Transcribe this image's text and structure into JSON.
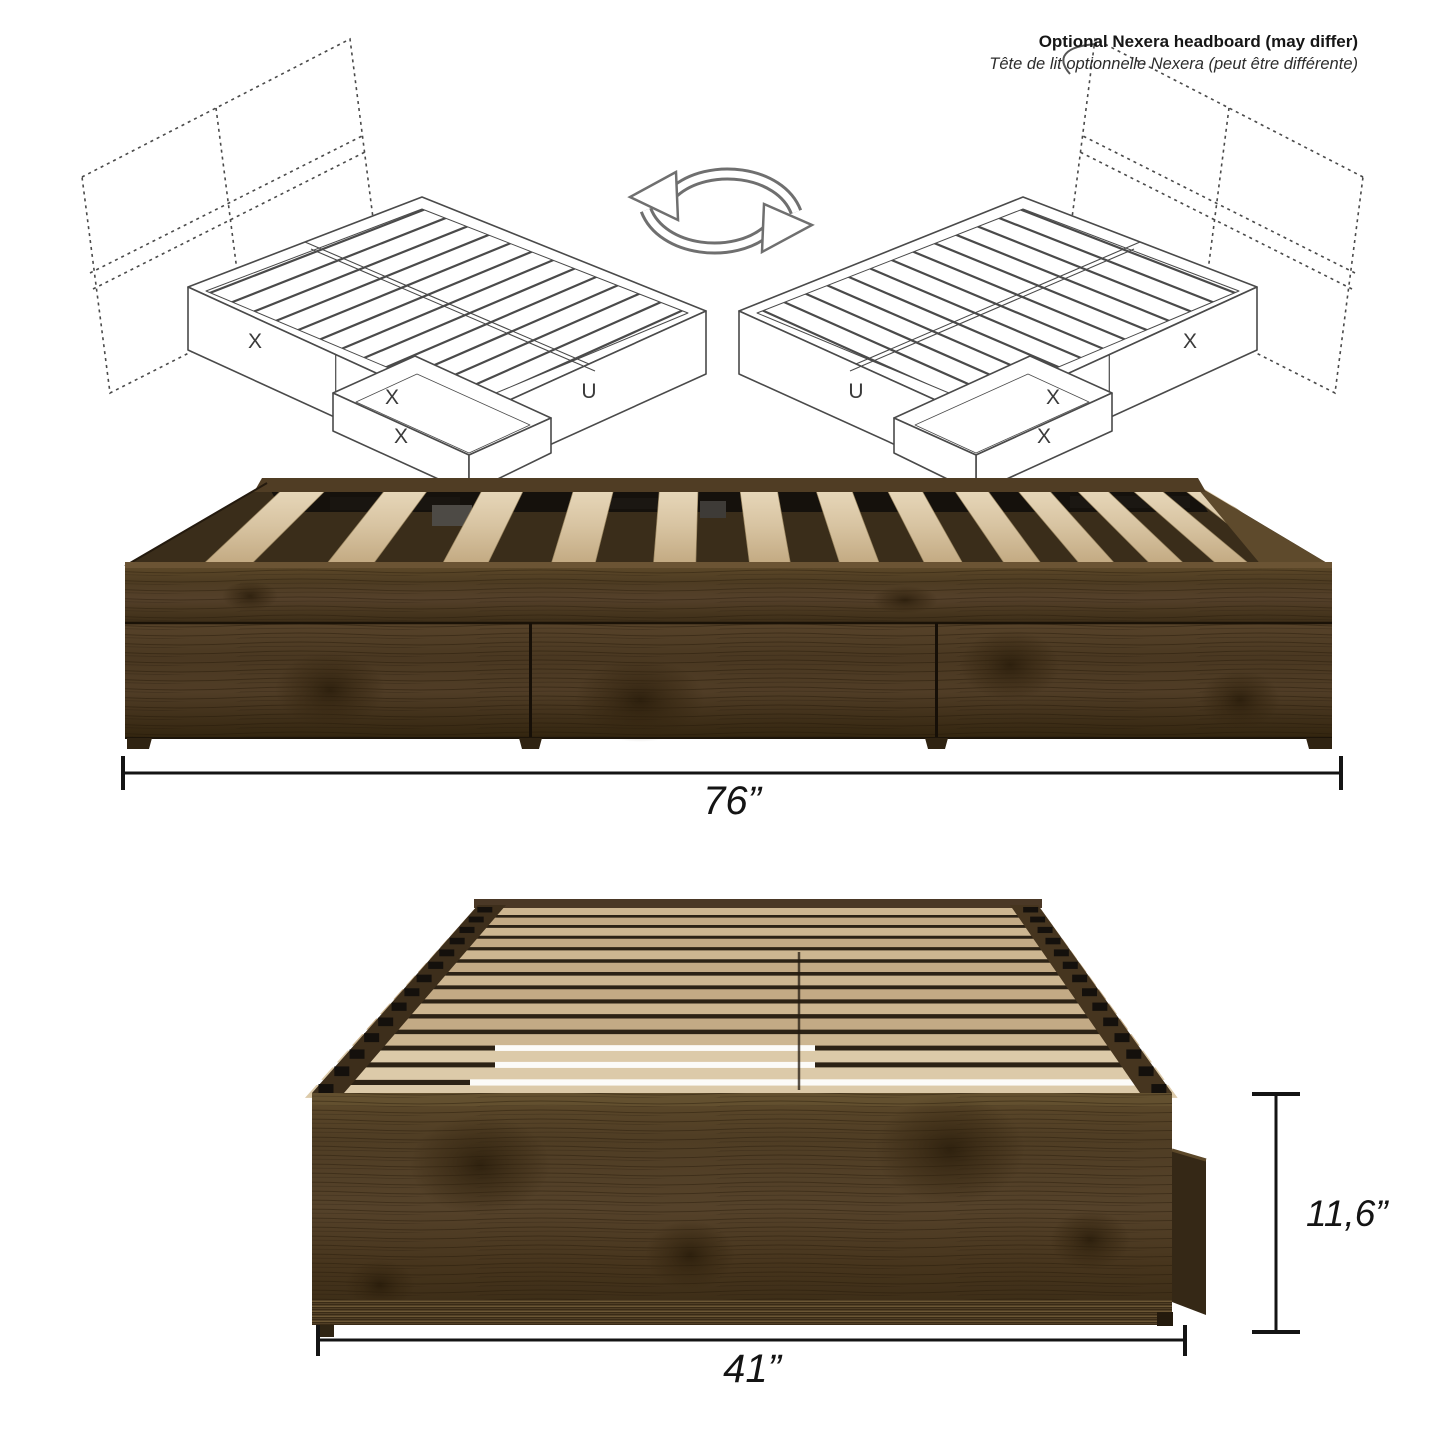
{
  "annotation": {
    "headboard_note_en": "Optional Nexera headboard (may differ)",
    "headboard_note_fr": "Tête de lit optionnelle Nexera (peut être différente)"
  },
  "diagram_labels": {
    "storage_drawer": "X",
    "open_side": "U"
  },
  "dimensions": {
    "length": "76”",
    "width": "41”",
    "height": "11,6”"
  },
  "icons": {
    "swap": "swap-arrows"
  },
  "colors": {
    "walnut": "#4c3a23",
    "slat_wood": "#d5c1a0",
    "line_art": "#4a4a4a",
    "dimension": "#141414"
  }
}
